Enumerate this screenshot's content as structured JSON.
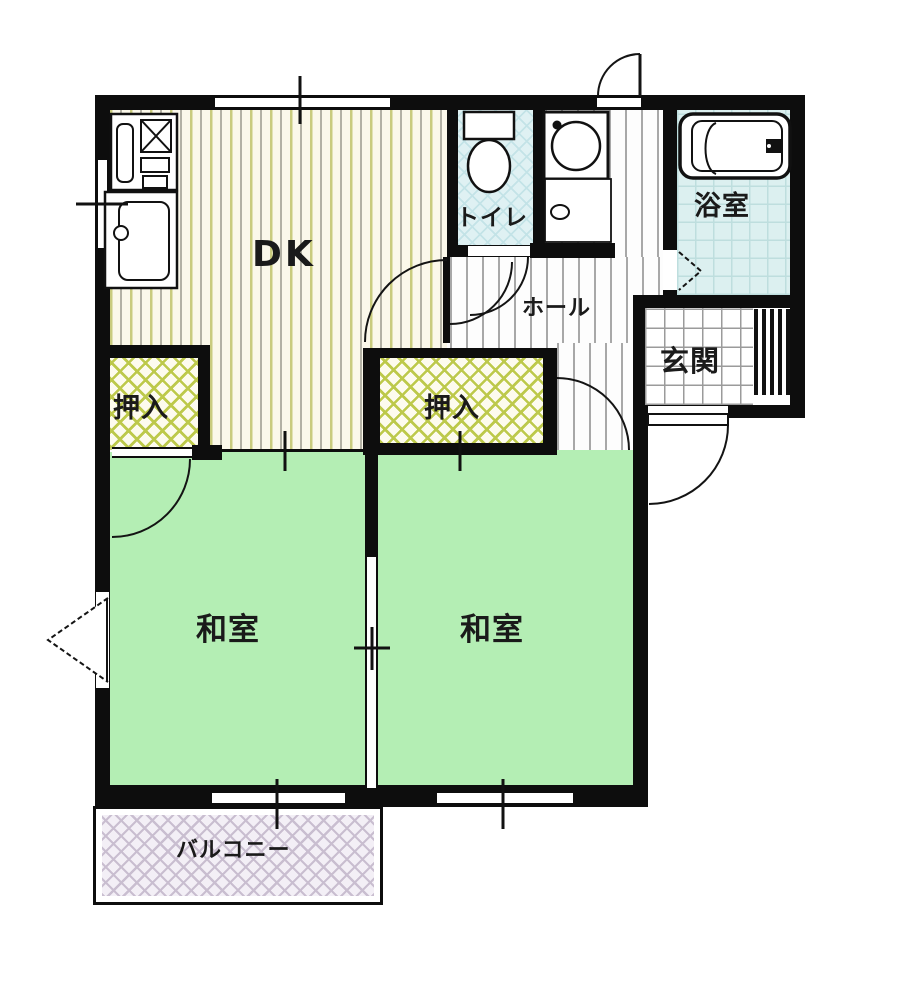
{
  "title": "2DK apartment floor plan",
  "rooms": {
    "dk": {
      "label": "DK"
    },
    "toilet": {
      "label": "トイレ"
    },
    "hall": {
      "label": "ホール"
    },
    "bathroom": {
      "label": "浴室"
    },
    "entrance": {
      "label": "玄関"
    },
    "closet_left": {
      "label": "押入"
    },
    "closet_right": {
      "label": "押入"
    },
    "washitsu_left": {
      "label": "和室"
    },
    "washitsu_right": {
      "label": "和室"
    },
    "balcony": {
      "label": "バルコニー"
    }
  },
  "icons": [
    "stove-icon",
    "kitchen-sink-icon",
    "toilet-icon",
    "washing-machine-icon",
    "washbasin-icon",
    "bathtub-icon",
    "door-arc",
    "folding-door-icon",
    "window-marker",
    "entrance-step-stripes"
  ],
  "colors": {
    "wall": "#0d0d0d",
    "tatami_room_green": "#b4eeb4",
    "dk_floor_cream": "#fbf8ea",
    "dk_stripe_olive": "#c9cb7e",
    "hall_stripe_gray": "#a8a8a8",
    "wet_area_blue": "#dff1f3",
    "closet_hatch_yellow": "#bdc94b",
    "balcony_hatch_lavender": "#c9bed0"
  }
}
